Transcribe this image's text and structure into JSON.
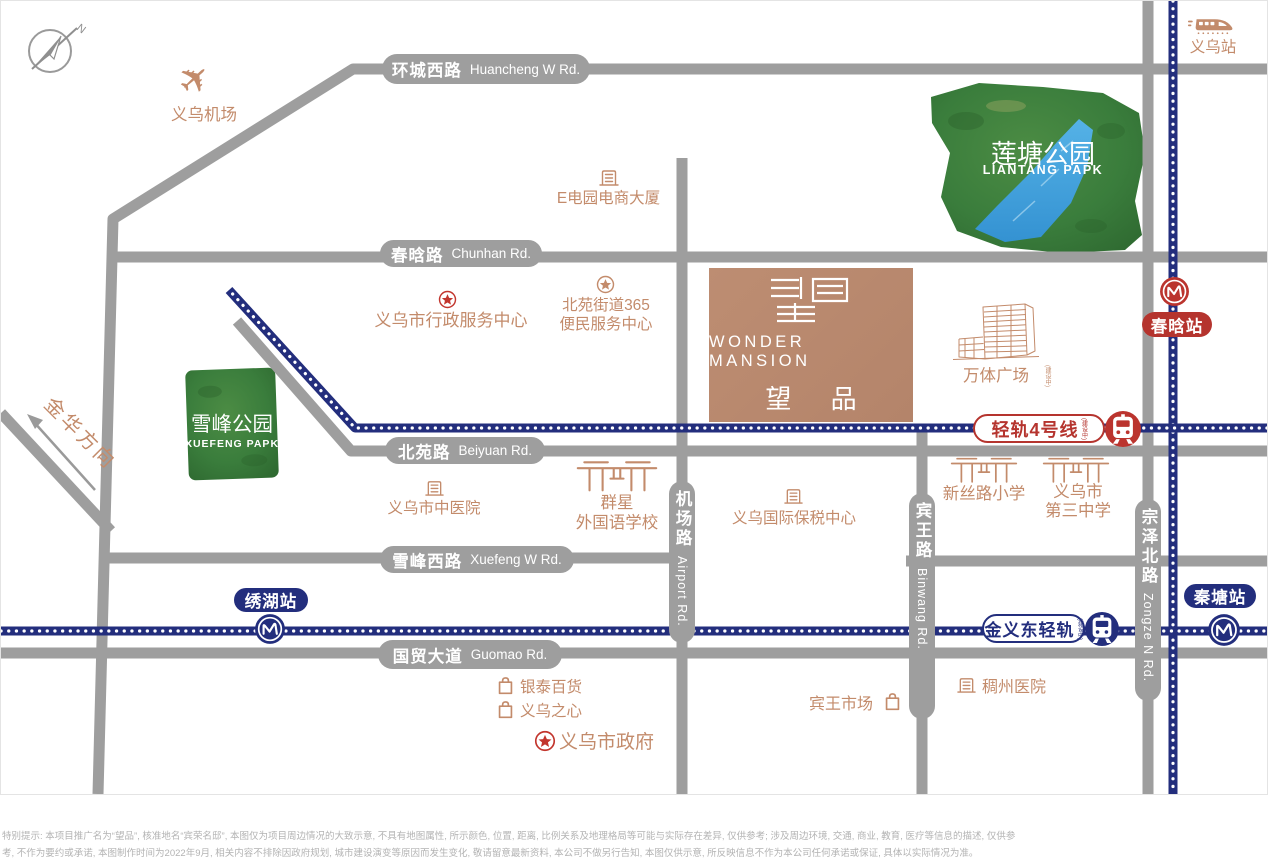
{
  "compass": {
    "n": "N"
  },
  "project": {
    "logo_en": "WONDER MANSION",
    "logo_cn": "望 品"
  },
  "roads": {
    "huancheng": {
      "cn": "环城西路",
      "en": "Huancheng W Rd."
    },
    "chunhan": {
      "cn": "春晗路",
      "en": "Chunhan Rd."
    },
    "beiyuan": {
      "cn": "北苑路",
      "en": "Beiyuan Rd."
    },
    "xuefeng_w": {
      "cn": "雪峰西路",
      "en": "Xuefeng W Rd."
    },
    "guomao": {
      "cn": "国贸大道",
      "en": "Guomao Rd."
    },
    "jichang": {
      "cn": "机场路",
      "en": "Airport Rd."
    },
    "binwang": {
      "cn": "宾王路",
      "en": "Binwang Rd."
    },
    "zongze": {
      "cn": "宗泽北路",
      "en": "Zongze N Rd."
    },
    "jinhua_direction": "金华方向"
  },
  "parks": {
    "liantang": {
      "cn": "莲塘公园",
      "en": "LIANTANG PAPK"
    },
    "xuefeng": {
      "cn": "雪峰公园",
      "en": "XUEFENG PAPK"
    }
  },
  "transit": {
    "yiwu_station": "义乌站",
    "chunhan_station": "春晗站",
    "xiuhu_station": "绣湖站",
    "qintang_station": "秦塘站",
    "rail4": {
      "label": "轻轨4号线",
      "note": "(建设中)"
    },
    "jinyidong": {
      "label": "金义东轻轨",
      "note": "(建设中)"
    }
  },
  "pois": {
    "airport": "义乌机场",
    "edianyuan": "E电园电商大厦",
    "xingzheng": "义乌市行政服务中心",
    "b365_line1": "北苑街道365",
    "b365_line2": "便民服务中心",
    "wanti": {
      "label": "万体广场",
      "note": "(建设中)"
    },
    "zhongyiyuan": "义乌市中医院",
    "qunxing_line1": "群星",
    "qunxing_line2": "外国语学校",
    "baoshui": "义乌国际保税中心",
    "xinsilu": "新丝路小学",
    "sanzhong_line1": "义乌市",
    "sanzhong_line2": "第三中学",
    "yintai": "银泰百货",
    "yiwuzhixin": "义乌之心",
    "shizhengfu": "义乌市政府",
    "binwang_market": "宾王市场",
    "chouzhou": "稠州医院"
  },
  "colors": {
    "road_gray": "#9e9e9e",
    "poi_tan": "#c38b6b",
    "rail_navy": "#232e7d",
    "badge_red": "#b5342e",
    "park_green": "#3a7d3c",
    "lake_blue": "#3f9fdc",
    "project_tan": "#bd8d72"
  },
  "disclaimer": {
    "line1": "特别提示: 本项目推广名为“望品”, 核准地名“宾荣名邸”, 本图仅为项目周边情况的大致示意, 不具有地图属性, 所示颜色, 位置, 距离, 比例关系及地理格局等可能与实际存在差异, 仅供参考; 涉及周边环境, 交通, 商业, 教育, 医疗等信息的描述, 仅供参",
    "line2": "考, 不作为要约或承诺, 本图制作时间为2022年9月, 相关内容不排除因政府规划, 城市建设演变等原因而发生变化, 敬请留意最新资料, 本公司不做另行告知, 本图仅供示意, 所反映信息不作为本公司任何承诺或保证, 具体以实际情况为准。"
  }
}
